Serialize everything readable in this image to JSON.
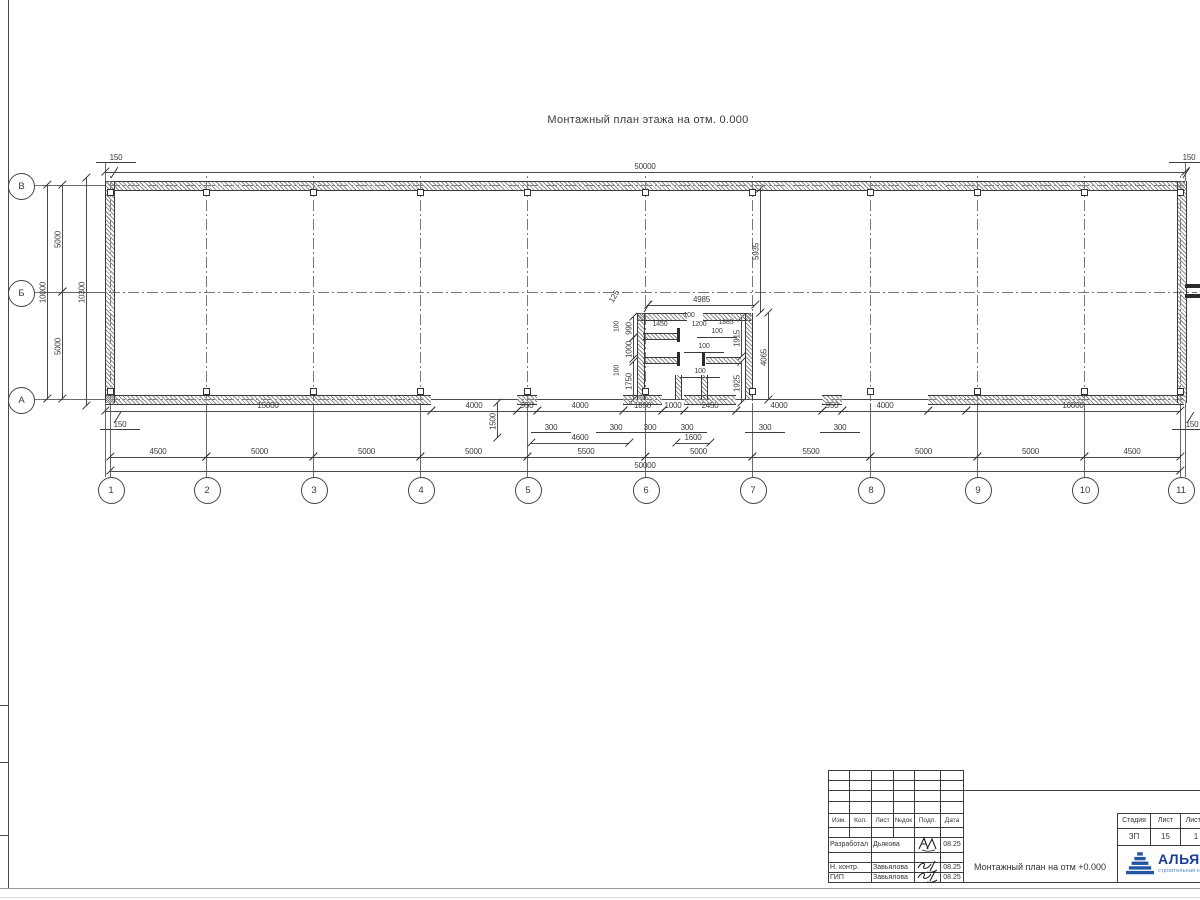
{
  "plan_title": "Монтажный план этажа на отм. 0.000",
  "colors": {
    "line": "#4a4a4a",
    "wall": "#3b3b3b",
    "logo_navy": "#1b3f99",
    "logo_blue": "#4a86c8",
    "triangle": "#2456a4"
  },
  "axis_columns": [
    {
      "label": "1",
      "x": 110
    },
    {
      "label": "2",
      "x": 206
    },
    {
      "label": "3",
      "x": 313
    },
    {
      "label": "4",
      "x": 420
    },
    {
      "label": "5",
      "x": 527
    },
    {
      "label": "6",
      "x": 645
    },
    {
      "label": "7",
      "x": 752
    },
    {
      "label": "8",
      "x": 870
    },
    {
      "label": "9",
      "x": 977
    },
    {
      "label": "10",
      "x": 1084
    },
    {
      "label": "11",
      "x": 1180
    }
  ],
  "axis_rows": [
    {
      "label": "В",
      "y": 185
    },
    {
      "label": "Б",
      "y": 292
    },
    {
      "label": "А",
      "y": 399
    }
  ],
  "drawing": {
    "dims_h": [
      {
        "x1": 105,
        "x2": 1185,
        "y": 172,
        "t": "50000"
      },
      {
        "x1": 105,
        "x2": 431,
        "y": 411,
        "t": "15000"
      },
      {
        "x1": 431,
        "x2": 517,
        "y": 411,
        "t": "4000"
      },
      {
        "x1": 517,
        "x2": 537,
        "y": 411,
        "t": "950"
      },
      {
        "x1": 537,
        "x2": 623,
        "y": 411,
        "t": "4000"
      },
      {
        "x1": 623,
        "x2": 662,
        "y": 411,
        "t": "1850"
      },
      {
        "x1": 662,
        "x2": 684,
        "y": 411,
        "t": "1000"
      },
      {
        "x1": 684,
        "x2": 736,
        "y": 411,
        "t": "2450"
      },
      {
        "x1": 736,
        "x2": 822,
        "y": 411,
        "t": "4000"
      },
      {
        "x1": 822,
        "x2": 842,
        "y": 411,
        "t": "950"
      },
      {
        "x1": 842,
        "x2": 928,
        "y": 411,
        "t": "4000"
      },
      {
        "x1": 928,
        "x2": 966,
        "y": 411,
        "t": ""
      },
      {
        "x1": 966,
        "x2": 1180,
        "y": 411,
        "t": "10000"
      },
      {
        "x1": 531,
        "x2": 629,
        "y": 443,
        "t": "4600"
      },
      {
        "x1": 676,
        "x2": 710,
        "y": 443,
        "t": "1600"
      },
      {
        "x1": 110,
        "x2": 206,
        "y": 457,
        "t": "4500"
      },
      {
        "x1": 206,
        "x2": 313,
        "y": 457,
        "t": "5000"
      },
      {
        "x1": 313,
        "x2": 420,
        "y": 457,
        "t": "5000"
      },
      {
        "x1": 420,
        "x2": 527,
        "y": 457,
        "t": "5000"
      },
      {
        "x1": 527,
        "x2": 645,
        "y": 457,
        "t": "5500"
      },
      {
        "x1": 645,
        "x2": 752,
        "y": 457,
        "t": "5000"
      },
      {
        "x1": 752,
        "x2": 870,
        "y": 457,
        "t": "5500"
      },
      {
        "x1": 870,
        "x2": 977,
        "y": 457,
        "t": "5000"
      },
      {
        "x1": 977,
        "x2": 1084,
        "y": 457,
        "t": "5000"
      },
      {
        "x1": 1084,
        "x2": 1180,
        "y": 457,
        "t": "4500"
      },
      {
        "x1": 110,
        "x2": 1180,
        "y": 471,
        "t": "50000"
      },
      {
        "x1": 648,
        "x2": 755,
        "y": 305,
        "t": "4985"
      }
    ],
    "dims_v": [
      {
        "x": 47,
        "y1": 185,
        "y2": 399,
        "t": "10000"
      },
      {
        "x": 62,
        "y1": 185,
        "y2": 292,
        "t": "5000"
      },
      {
        "x": 62,
        "y1": 292,
        "y2": 399,
        "t": "5000"
      },
      {
        "x": 86,
        "y1": 178,
        "y2": 406,
        "t": "10300"
      },
      {
        "x": 760,
        "y1": 189,
        "y2": 313,
        "t": "5935"
      },
      {
        "x": 768,
        "y1": 313,
        "y2": 400,
        "t": "4065"
      },
      {
        "x": 741,
        "y1": 318,
        "y2": 357,
        "t": "1915"
      },
      {
        "x": 741,
        "y1": 362,
        "y2": 403,
        "t": "1925"
      },
      {
        "x": 633,
        "y1": 317,
        "y2": 338,
        "t": "990"
      },
      {
        "x": 633,
        "y1": 338,
        "y2": 359,
        "t": "1000"
      },
      {
        "x": 633,
        "y1": 362,
        "y2": 400,
        "t": "1750"
      },
      {
        "x": 497,
        "y1": 403,
        "y2": 438,
        "t": "1500"
      }
    ],
    "labels": [
      {
        "t": "150",
        "x": 116,
        "y": 157,
        "u": true
      },
      {
        "t": "150",
        "x": 1189,
        "y": 157,
        "u": true
      },
      {
        "t": "150",
        "x": 120,
        "y": 424,
        "u": true
      },
      {
        "t": "150",
        "x": 1192,
        "y": 424,
        "u": true
      },
      {
        "t": "300",
        "x": 551,
        "y": 427,
        "u": true
      },
      {
        "t": "300",
        "x": 616,
        "y": 427,
        "u": true
      },
      {
        "t": "300",
        "x": 650,
        "y": 427,
        "u": true
      },
      {
        "t": "300",
        "x": 687,
        "y": 427,
        "u": true
      },
      {
        "t": "300",
        "x": 765,
        "y": 427,
        "u": true
      },
      {
        "t": "300",
        "x": 840,
        "y": 427,
        "u": true
      },
      {
        "t": "125",
        "x": 614,
        "y": 296,
        "rot": -60
      },
      {
        "t": "100",
        "x": 689,
        "y": 316,
        "fs": 7
      },
      {
        "t": "1200",
        "x": 699,
        "y": 325,
        "fs": 7
      },
      {
        "t": "1450",
        "x": 660,
        "y": 325,
        "fs": 7
      },
      {
        "t": "1885",
        "x": 726,
        "y": 323,
        "fs": 7
      },
      {
        "t": "100",
        "x": 717,
        "y": 332,
        "u": true,
        "fs": 7
      },
      {
        "t": "100",
        "x": 618,
        "y": 326,
        "rot": -90,
        "fs": 7
      },
      {
        "t": "100",
        "x": 618,
        "y": 370,
        "rot": -90,
        "fs": 7
      },
      {
        "t": "100",
        "x": 704,
        "y": 347,
        "u": true,
        "fs": 7
      },
      {
        "t": "100",
        "x": 700,
        "y": 372,
        "u": true,
        "fs": 7
      }
    ],
    "slants": [
      {
        "x": 108,
        "y": 172
      },
      {
        "x": 1180,
        "y": 172
      },
      {
        "x": 111,
        "y": 417
      },
      {
        "x": 1184,
        "y": 417
      },
      {
        "x": 641,
        "y": 306
      }
    ]
  },
  "titleblock": {
    "header_cols": [
      "Изм.",
      "Кол.",
      "Лист",
      "№док",
      "Подп.",
      "Дата"
    ],
    "rows": [
      {
        "role": "Разработал",
        "name": "Дьякова",
        "date": "08.25"
      },
      {
        "role": "Н. контр.",
        "name": "Завьялова",
        "date": "08.25"
      },
      {
        "role": "ГИП",
        "name": "Завьялова",
        "date": "08.25"
      }
    ],
    "doc_title": "Монтажный план на отм +0.000",
    "stage_cols": [
      "Стадия",
      "Лист",
      "Листов"
    ],
    "stage_vals": [
      "ЗП",
      "15",
      "1"
    ],
    "logo_text": "АЛЬЯНС",
    "logo_sub": "строительная компания"
  }
}
